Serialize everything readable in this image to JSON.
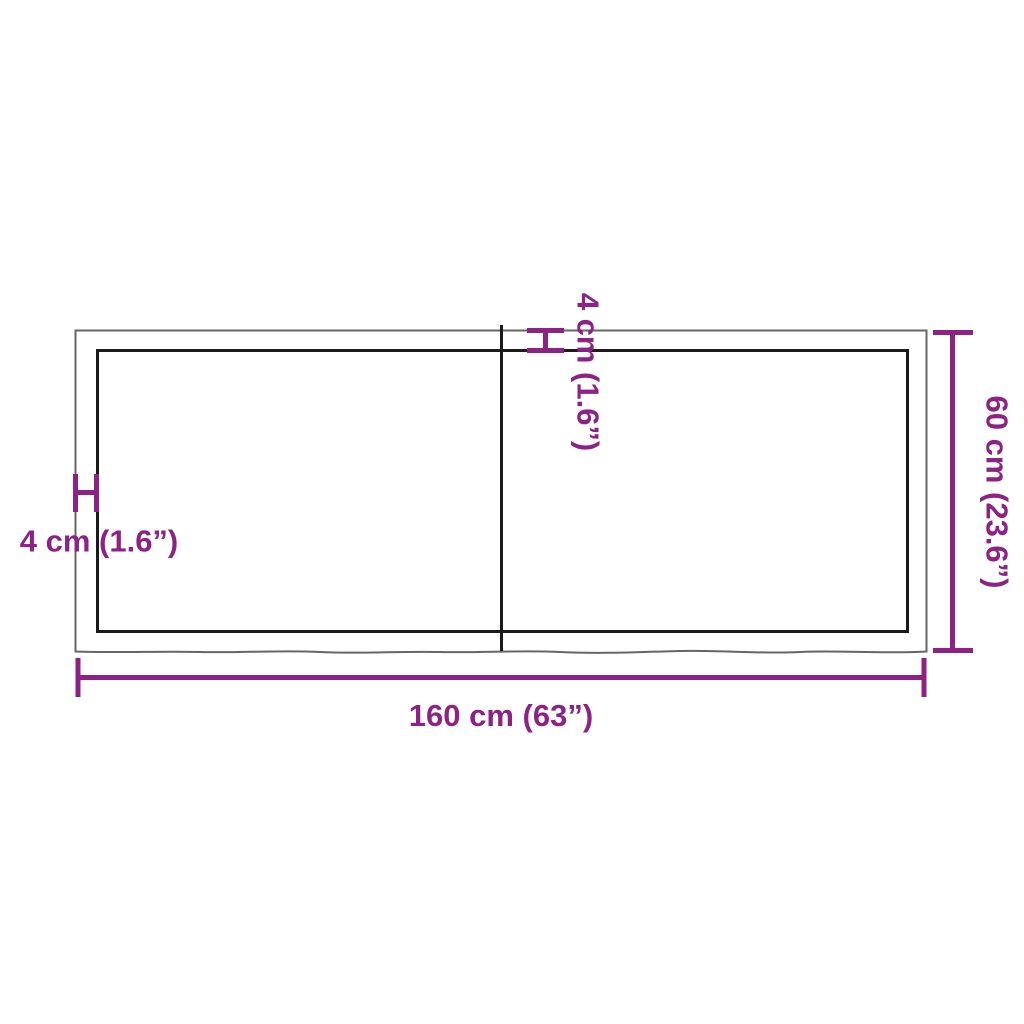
{
  "diagram": {
    "type": "product-dimension-diagram",
    "subject": "rectangular wooden table top with border frame and center seam",
    "width_label": "160 cm (63”)",
    "height_label": "60 cm (23.6”)",
    "thickness_label_left": "4 cm (1.6”)",
    "thickness_label_top": "4 cm (1.6”)"
  },
  "colors": {
    "accent": "#8e2186",
    "ink": "#1a1a1a",
    "outline": "#666666",
    "bg": "#ffffff"
  }
}
